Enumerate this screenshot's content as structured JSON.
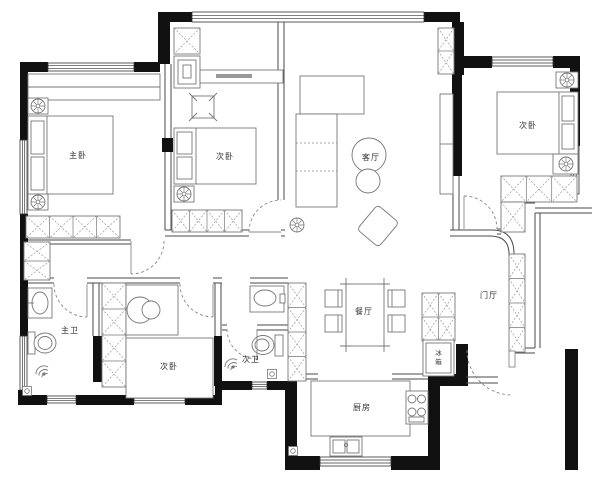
{
  "plan": {
    "background": "#ffffff",
    "wall_color": "#111111",
    "line_color": "#555555"
  },
  "rooms": {
    "master_bedroom": {
      "label": "主卧"
    },
    "bedroom_top_center": {
      "label": "次卧"
    },
    "bedroom_top_right": {
      "label": "次卧"
    },
    "bedroom_bottom": {
      "label": "次卧"
    },
    "living_room": {
      "label": "客厅"
    },
    "dining_room": {
      "label": "餐厅"
    },
    "foyer": {
      "label": "门厅"
    },
    "kitchen": {
      "label": "厨房"
    },
    "master_bathroom": {
      "label": "主卫"
    },
    "second_bathroom": {
      "label": "次卫"
    },
    "refrigerator": {
      "label": "冰箱",
      "char_top": "冰",
      "char_bottom": "箱"
    }
  }
}
